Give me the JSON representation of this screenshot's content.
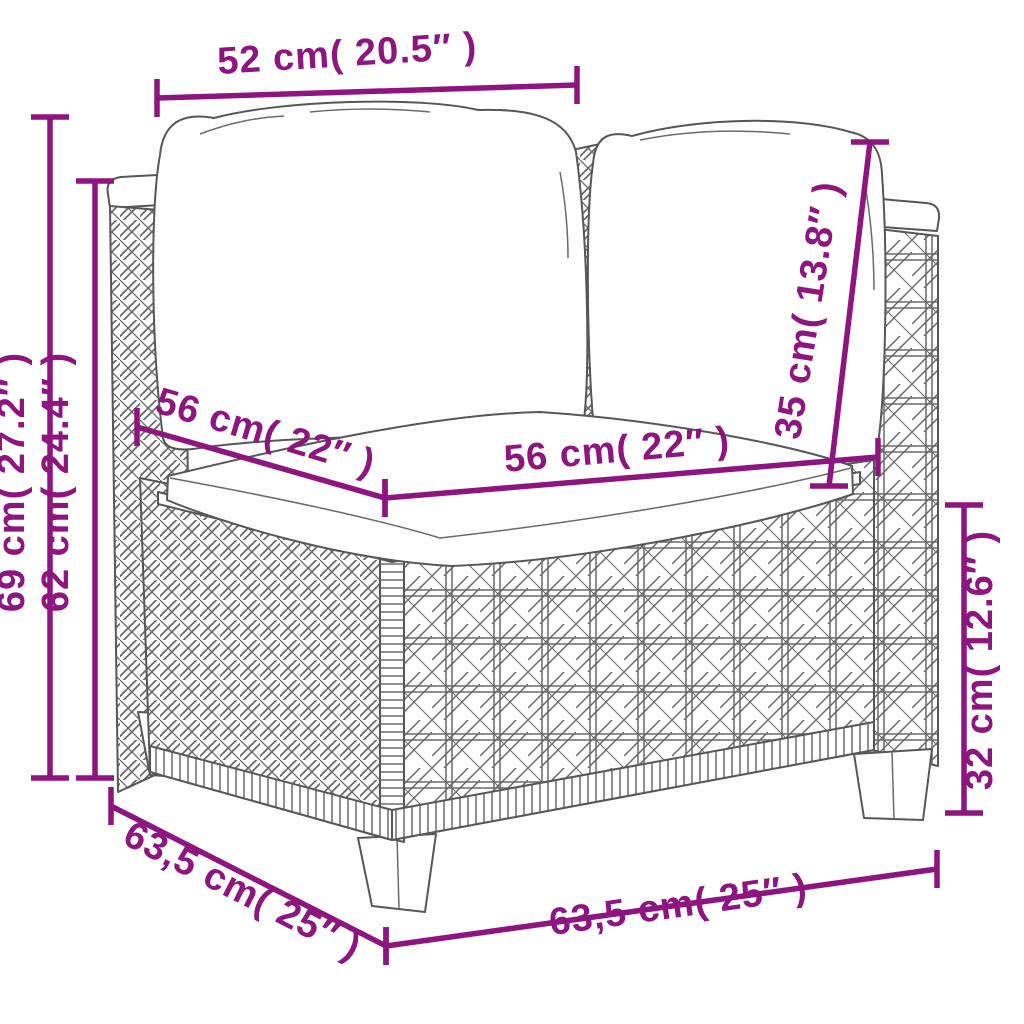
{
  "figure": {
    "subject": "poly rattan corner sofa section with back and seat cushions — dimension diagram",
    "accent_color": "#8E1480",
    "outline_color": "#575757",
    "background": "#ffffff"
  },
  "dimensions": [
    {
      "id": "top-width",
      "label": "52 cm( 20.5″ )",
      "cm": "52",
      "inches": "20.5″",
      "x1": 157,
      "y1": 98,
      "x2": 577,
      "y2": 85,
      "tick": "v",
      "lx": 348,
      "ly": 66,
      "rot": -3.5
    },
    {
      "id": "overall-height",
      "label": "69 cm( 27.2″ )",
      "cm": "69",
      "inches": "27.2″",
      "x1": 50,
      "y1": 117,
      "x2": 50,
      "y2": 778,
      "tick": "h",
      "lx": 24,
      "ly": 482,
      "rot": -90
    },
    {
      "id": "arm-height",
      "label": "62 cm( 24.4″ )",
      "cm": "62",
      "inches": "24.4″",
      "x1": 95,
      "y1": 181,
      "x2": 95,
      "y2": 778,
      "tick": "h",
      "lx": 68,
      "ly": 482,
      "rot": -90
    },
    {
      "id": "seat-depth",
      "label": "56 cm( 22″ )",
      "cm": "56",
      "inches": "22″",
      "x1": 137,
      "y1": 427,
      "x2": 385,
      "y2": 498,
      "tick": "v",
      "lx": 262,
      "ly": 444,
      "rot": 16.5
    },
    {
      "id": "seat-width",
      "label": "56 cm( 22″ )",
      "cm": "56",
      "inches": "22″",
      "x1": 385,
      "y1": 498,
      "x2": 878,
      "y2": 457,
      "tick": "v",
      "lx": 618,
      "ly": 462,
      "rot": -5
    },
    {
      "id": "backrest-height",
      "label": "35 cm( 13.8″ )",
      "cm": "35",
      "inches": "13.8″",
      "x1": 829,
      "y1": 486,
      "x2": 870,
      "y2": 142,
      "tick": "h",
      "lx": 820,
      "ly": 312,
      "rot": -81
    },
    {
      "id": "base-height",
      "label": "32 cm( 12.6″ )",
      "cm": "32",
      "inches": "12.6″",
      "x1": 964,
      "y1": 505,
      "x2": 964,
      "y2": 813,
      "tick": "h",
      "lx": 992,
      "ly": 660,
      "rot": -90
    },
    {
      "id": "base-depth",
      "label": "63,5 cm( 25″ )",
      "cm": "63,5",
      "inches": "25″",
      "x1": 111,
      "y1": 806,
      "x2": 386,
      "y2": 946,
      "tick": "v",
      "lx": 237,
      "ly": 902,
      "rot": 27
    },
    {
      "id": "base-width",
      "label": "63,5 cm( 25″ )",
      "cm": "63,5",
      "inches": "25″",
      "x1": 386,
      "y1": 946,
      "x2": 937,
      "y2": 869,
      "tick": "v",
      "lx": 680,
      "ly": 917,
      "rot": -8
    }
  ]
}
